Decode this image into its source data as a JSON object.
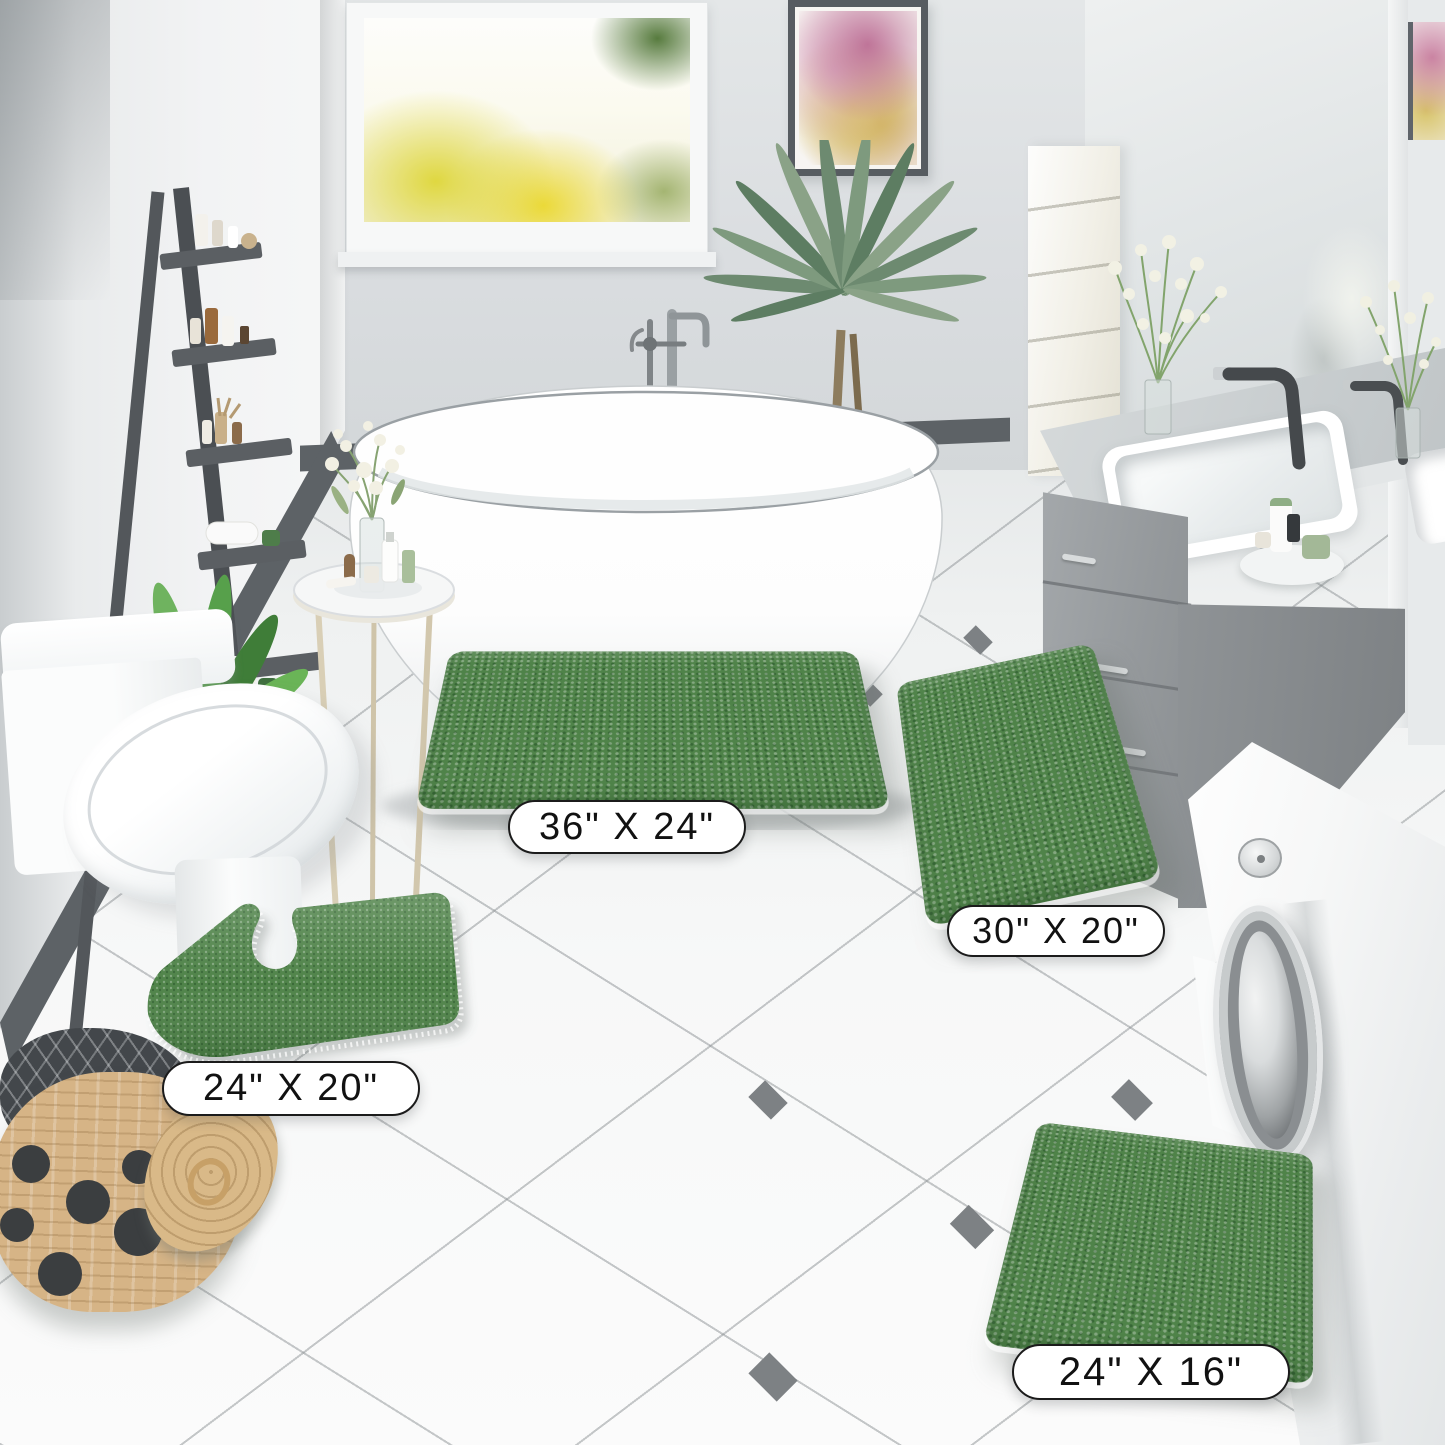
{
  "product": {
    "title": "Chenille Bath Mat Set",
    "color": "Green",
    "mats": [
      {
        "id": "rectangle-large",
        "size_label": "36\" X 24\""
      },
      {
        "id": "runner",
        "size_label": "30\" X 20\""
      },
      {
        "id": "contour-u-shape",
        "size_label": "24\" X 20\""
      },
      {
        "id": "rectangle-small",
        "size_label": "24\" X 16\""
      }
    ]
  },
  "scene": {
    "room": "bathroom",
    "objects": [
      "freestanding bathtub",
      "chrome floor faucet",
      "ladder shelf with toiletries",
      "window with autumn trees",
      "watercolor wall art",
      "palm plant",
      "potted plant beside toilet",
      "round side table with vase and toiletries",
      "toilet",
      "gray double-sink vanity",
      "wall mirror",
      "washing machine",
      "wicker laundry basket with polka dots",
      "white tile floor with diamond accents"
    ],
    "palette": {
      "mat_green": "#4f8349",
      "wall": "#dcdfe1",
      "left_wall": "#f0f1f2",
      "baseboard": "#5b6064",
      "floor": "#f4f5f6",
      "grout": "#9aa0a3",
      "tile_diamond": "#7d8184",
      "vanity_gray": "#989da0",
      "ladder_gray": "#54585c",
      "basket_tan": "#d4b286",
      "label_border": "#1b1b1b",
      "label_bg": "#ffffff"
    }
  }
}
